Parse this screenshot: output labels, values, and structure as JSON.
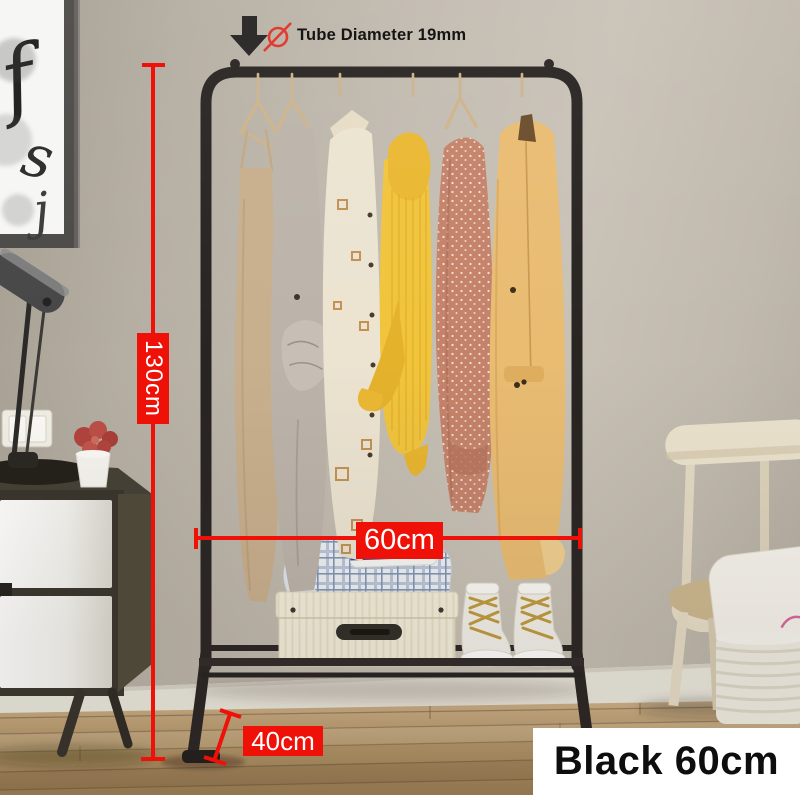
{
  "product_annotations": {
    "tube_diameter": {
      "label": "Tube Diameter 19mm",
      "icons": [
        "down-arrow-icon",
        "diameter-icon"
      ]
    },
    "height": {
      "label": "130cm"
    },
    "width": {
      "label": "60cm"
    },
    "depth": {
      "label": "40cm"
    }
  },
  "variant_badge": {
    "label": "Black 60cm",
    "bg": "#ffffff",
    "text_color": "#0e0e0e"
  },
  "colors": {
    "annotation_red": "#ef1008",
    "annotation_text": "#ffffff",
    "tube_label_text": "#151412",
    "rack_black": "#282422",
    "wall": "#c1baae",
    "floor_wood": "#b29467",
    "baseboard": "#e9e6db",
    "coat_camel": "#e9bc72",
    "sweater_yellow": "#f1c43c",
    "box_cream": "#f4efdc"
  },
  "scene": {
    "artwork_glyphs": [
      "f",
      "s",
      "j"
    ]
  }
}
